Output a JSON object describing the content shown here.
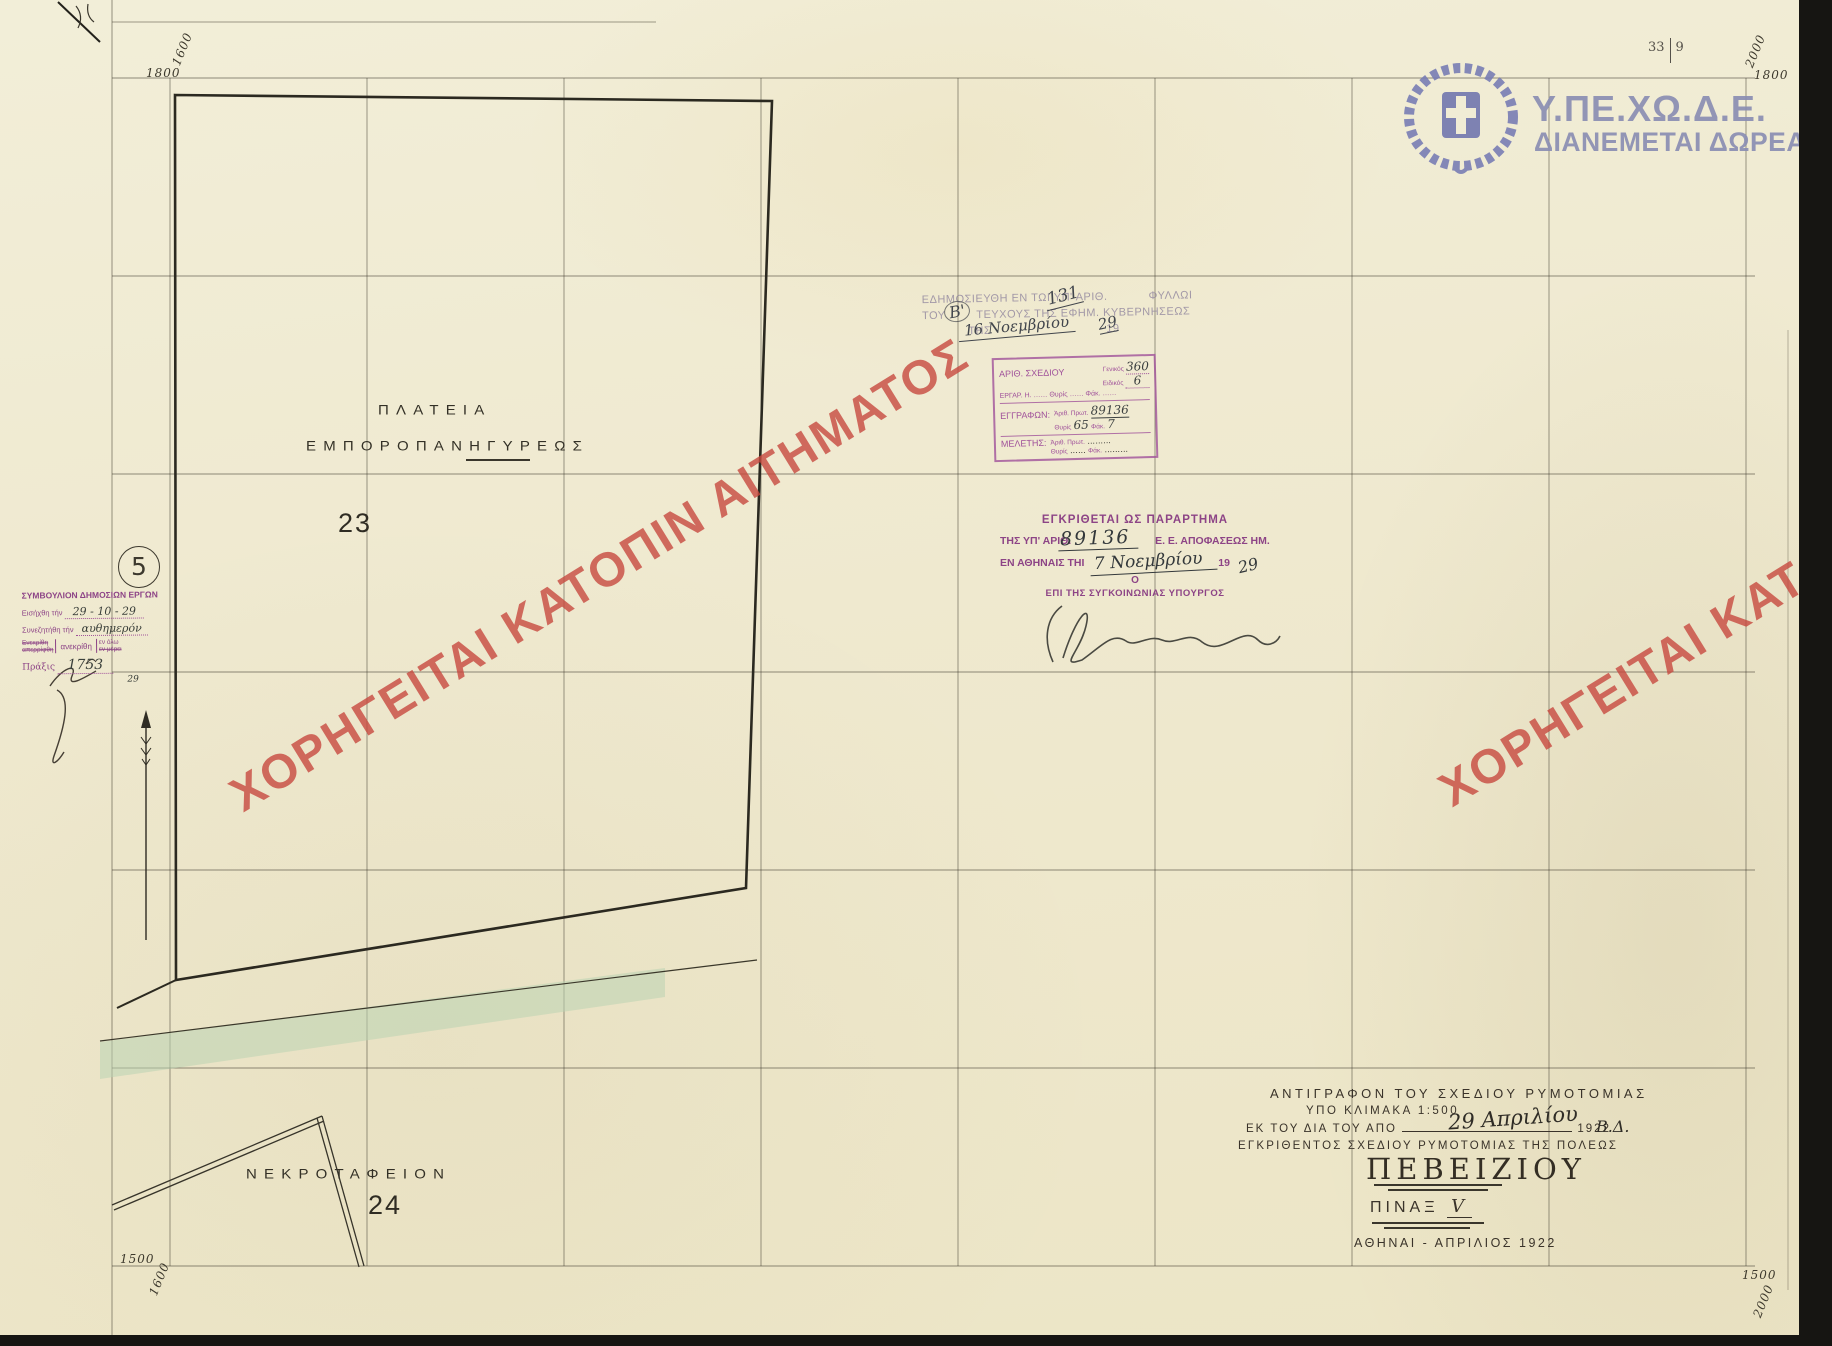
{
  "sheet_ref": {
    "left": "33",
    "right": "9"
  },
  "agency": {
    "name": "Υ.ΠΕ.ΧΩ.Δ.Ε.",
    "tagline": "ΔΙΑΝΕΜΕΤΑΙ ΔΩΡΕΑΝ",
    "color": "#8a8db2"
  },
  "watermark": {
    "text": "ΧΟΡΗΓΕΙΤΑΙ ΚΑΤΟΠΙΝ ΑΙΤΗΜΑΤΟΣ",
    "color": "#c7493e"
  },
  "corners": {
    "top_left_n": "1800",
    "top_left_e": "1600",
    "top_right_e": "2000",
    "top_right_n": "1800",
    "bottom_left_n": "1500",
    "bottom_left_e": "1600",
    "bottom_right_n": "1500",
    "bottom_right_e": "2000"
  },
  "publication_stamp": {
    "line1_prefix": "ΕΔΗΜΟΣΙΕΥΘΗ ΕΝ ΤΩΙ ΥΠ' ΑΡΙΘ.",
    "issue_number": "131",
    "line1_suffix": "ΦΥΛΛΩΙ",
    "line2_prefix": "ΤΟΥ",
    "volume": "Β'",
    "line2_suffix": "ΤΕΥΧΟΥΣ ΤΗΣ ΕΦΗΜ. ΚΥΒΕΡΝΗΣΕΩΣ",
    "line3_prefix": "ΤΗΣ",
    "date": "16 Νοεμβρίου",
    "year_prefix": "19",
    "year": "29"
  },
  "registry_stamp": {
    "row1_label": "ΑΡΙΘ. ΣΧΕΔΙΟΥ",
    "general_label": "Γενικός",
    "general_value": "360",
    "special_label": "Ειδικός",
    "special_value": "6",
    "row2_label": "ΕΡΓΑΡ. Η.",
    "thyris_word": "Θυρίς",
    "fak_word": "Φάκ.",
    "row3_label": "ΕΓΓΡΑΦΩΝ:",
    "prot_label": "Ἀριθ. Πρωτ.",
    "prot_value": "89136",
    "thyris_value": "65",
    "fak_value": "7",
    "row4_label": "ΜΕΛΕΤΗΣ:"
  },
  "approval_stamp": {
    "line1": "ΕΓΚΡΙΘΕΤΑΙ ΩΣ ΠΑΡΑΡΤΗΜΑ",
    "line2_prefix": "ΤΗΣ ΥΠ' ΑΡΙΘ.",
    "decision_number": "89136",
    "line2_suffix": "Ε. Ε. ΑΠΟΦΑΣΕΩΣ ΗΜ.",
    "line3_prefix": "ΕΝ ΑΘΗΝΑΙΣ ΤΗΙ",
    "date": "7 Νοεμβρίου",
    "year_prefix": "19",
    "year": "29",
    "article": "Ο",
    "line5": "ΕΠΙ ΤΗΣ ΣΥΓΚΟΙΝΩΝΙΑΣ ΥΠΟΥΡΓΟΣ"
  },
  "council_stamp": {
    "title": "ΣΥΜΒΟΥΛΙΟΝ ΔΗΜΟΣΙΩΝ ΕΡΓΩΝ",
    "intro_label": "Εισήχθη τήν",
    "intro_value": "29 - 10 - 29",
    "discussed_label": "Συνεζητήθη τήν",
    "discussed_value": "αυθημερόν",
    "approved_struck_a": "Ενεκρίθη",
    "approved_struck_b": "απερρίφθη",
    "approved_word": "ανεκρίθη",
    "scope_a": "εν όλω",
    "scope_b": "εν μέρει",
    "act_label": "Πράξις",
    "act_value": "1753",
    "note": "29"
  },
  "item_number_badge": "5",
  "map": {
    "square_label_line1": "ΠΛΑΤΕΙΑ",
    "square_label_line2": "ΕΜΠΟΡΟΠΑΝΗΓΥΡΕΩΣ",
    "block_23": "23",
    "cemetery_label": "ΝΕΚΡΟΤΑΦΕΙΟΝ",
    "block_24": "24",
    "road_color": "#b9d3b3"
  },
  "title_block": {
    "line1": "ΑΝΤΙΓΡΑΦΟΝ ΤΟΥ ΣΧΕΔΙΟΥ ΡΥΜΟΤΟΜΙΑΣ",
    "line2": "ΥΠΟ ΚΛΙΜΑΚΑ 1:500",
    "line3_prefix": "ΕΚ ΤΟΥ ΔΙΑ ΤΟΥ ΑΠΟ",
    "decree_date": "29 Απριλίου",
    "decree_year": "1922",
    "decree_suffix": "Β.Δ.",
    "line4": "ΕΓΚΡΙΘΕΝΤΟΣ ΣΧΕΔΙΟΥ ΡΥΜΟΤΟΜΙΑΣ ΤΗΣ ΠΟΛΕΩΣ",
    "city": "ΠΕΒΕΙΖΙΟΥ",
    "plate_label": "ΠΙΝΑΞ",
    "plate_number": "V",
    "footer": "ΑΘΗΝΑΙ - ΑΠΡΙΛΙΟΣ 1922"
  }
}
